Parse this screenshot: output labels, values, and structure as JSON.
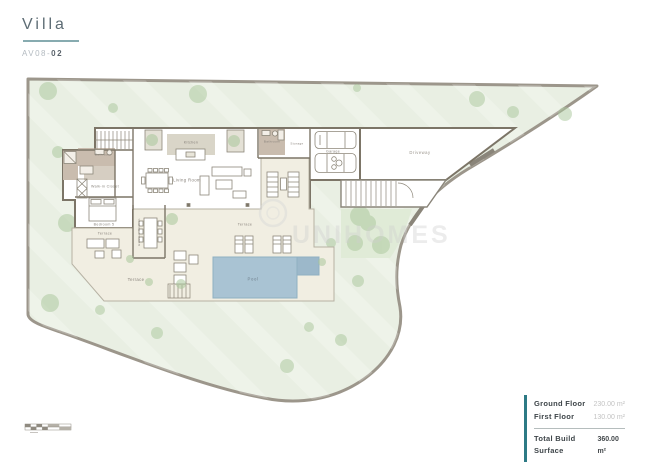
{
  "header": {
    "title": "Villa",
    "code_prefix": "AV08-",
    "code_number": "02"
  },
  "watermark": {
    "brand": "UNIHOMES"
  },
  "plan": {
    "labels": {
      "kitchen": "Kitchen",
      "living_room": "Living Room",
      "bathroom_left": "Bathroom",
      "bathroom_right": "Bathroom",
      "storage": "Storage",
      "garage": "Garage",
      "driveway": "Driveway",
      "walk_in_closet": "Walk-in Closet",
      "bedroom_5": "Bedroom 5",
      "terrace_small": "Terrace",
      "terrace_center": "Terrace",
      "terrace_bottom": "Terrace",
      "exterior_kitchen": "Exterior Kitchen",
      "pool": "Pool"
    }
  },
  "legend": {
    "rows": [
      {
        "label": "Ground Floor",
        "value": "230.00 m²"
      },
      {
        "label": "First Floor",
        "value": "130.00 m²"
      }
    ],
    "total": {
      "label": "Total Build Surface",
      "value": "360.00 m²"
    }
  },
  "colors": {
    "site_green": "#e9efe3",
    "garden_green": "#e0ebd7",
    "tree_green": "#a9c79b",
    "boundary_gray": "#9c968b",
    "wall_dark": "#7c7567",
    "terrace_cream": "#f1eee2",
    "kitchen_gray": "#d9d5c8",
    "bath_brown": "#c9bcae",
    "pool_blue": "#a9c3d3",
    "jacuzzi_blue": "#9cb8ca",
    "accent_teal": "#2d7a85"
  }
}
